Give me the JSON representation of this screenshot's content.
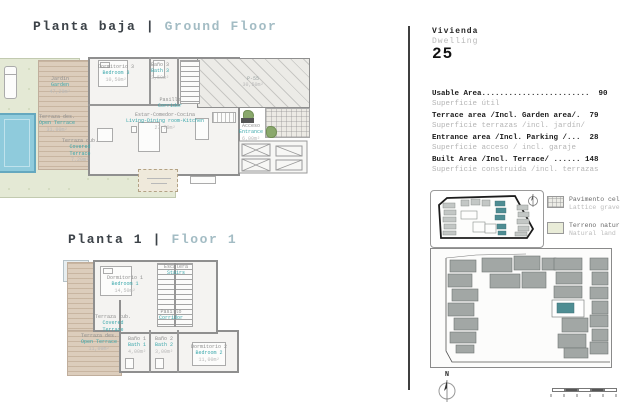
{
  "titles": {
    "ground_es": "Planta baja",
    "ground_en": "Ground Floor",
    "floor1_es": "Planta 1",
    "floor1_en": "Floor 1",
    "divider": "|"
  },
  "dwelling": {
    "label_es": "Vivienda",
    "label_en": "Dwelling",
    "number": "25"
  },
  "areas": [
    {
      "en": "Usable Area........................  90",
      "es": "Superficie útil"
    },
    {
      "en": "Terrace area /Incl. Garden area/.  79",
      "es": "Superficie terrazas /incl. jardín/"
    },
    {
      "en": "Entrance area /Incl. Parking /...  28",
      "es": "Superficie acceso / incl. garaje"
    },
    {
      "en": "Built Area /Incl. Terrace/ ...... 148",
      "es": "Superficie construida /incl. terrazas"
    }
  ],
  "legend": [
    {
      "es": "Pavimento celosía |",
      "en": "Lattice gravel pav"
    },
    {
      "es": "Terreno natural |",
      "en": "Natural land"
    }
  ],
  "ground_rooms": [
    {
      "es": "Jardín",
      "en": "Garden",
      "area": "47,29m²"
    },
    {
      "es": "Dormitorio 3",
      "en": "Bedroom 3",
      "area": "10,50m²"
    },
    {
      "es": "Baño 3",
      "en": "Bath 3",
      "area": "3,50m²"
    },
    {
      "es": "Pasillo",
      "en": "Corridor",
      "area": ""
    },
    {
      "es": "Estar-Comedor-Cocina",
      "en": "Living-Dining room-Kitchen",
      "area": "27,70m²"
    },
    {
      "es": "Terraza des.",
      "en": "Open Terrace",
      "area": "31,00m²"
    },
    {
      "es": "Terraza cub.",
      "en": "Covered Terrace",
      "area": "7,20m²"
    },
    {
      "es": "P-55",
      "en": "",
      "area": "30,50m²"
    },
    {
      "es": "Acceso",
      "en": "Entrance",
      "area": "6,00m²"
    }
  ],
  "floor1_rooms": [
    {
      "es": "Dormitorio 1",
      "en": "Bedroom 1",
      "area": "14,50m²"
    },
    {
      "es": "Escalera",
      "en": "Stairs",
      "area": ""
    },
    {
      "es": "Pasillo",
      "en": "Corridor",
      "area": ""
    },
    {
      "es": "Terraza cub.",
      "en": "Covered Terrace",
      "area": ""
    },
    {
      "es": "Terraza des.",
      "en": "Open Terrace",
      "area": "11,00m²"
    },
    {
      "es": "Baño 1",
      "en": "Bath 1",
      "area": "4,00m²"
    },
    {
      "es": "Baño 2",
      "en": "Bath 2",
      "area": "3,00m²"
    },
    {
      "es": "Dormitorio 2",
      "en": "Bedroom 2",
      "area": "11,00m²"
    }
  ],
  "compass": {
    "north": "N"
  },
  "colors": {
    "title_dark": "#3c4248",
    "title_light": "#a3bcc4",
    "label_teal": "#3aa7ab",
    "garden_green": "#e4e9d5",
    "deck_tan": "#dccdbc",
    "pool_blue": "#8fcbdc",
    "site_building_gray": "#a2a7a5",
    "highlight_teal": "#4e8d93"
  }
}
